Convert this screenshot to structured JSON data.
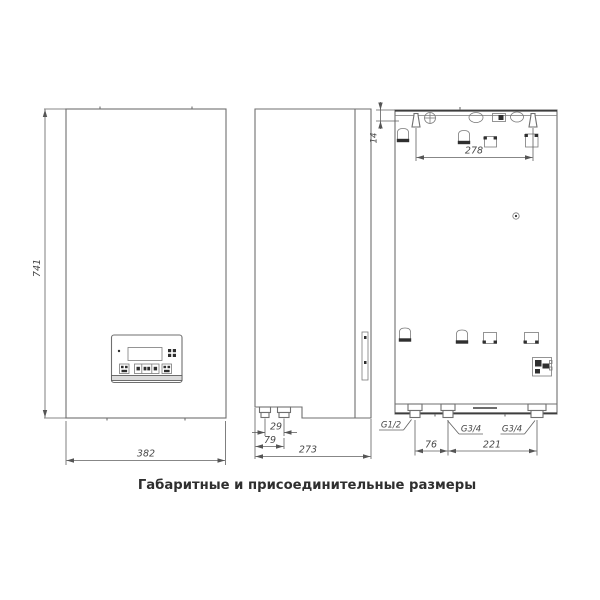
{
  "caption": "Габаритные и присоединительные размеры",
  "front": {
    "height": "741",
    "width": "382"
  },
  "side": {
    "depth": "273",
    "nozzle_offset": "79",
    "nozzle_spacing": "29"
  },
  "rear": {
    "hanger_top_offset": "14",
    "hanger_spacing": "278",
    "conn_spacing_left": "76",
    "conn_spacing_right": "221",
    "conn_left": "G1/2",
    "conn_mid": "G3/4",
    "conn_right": "G3/4"
  }
}
